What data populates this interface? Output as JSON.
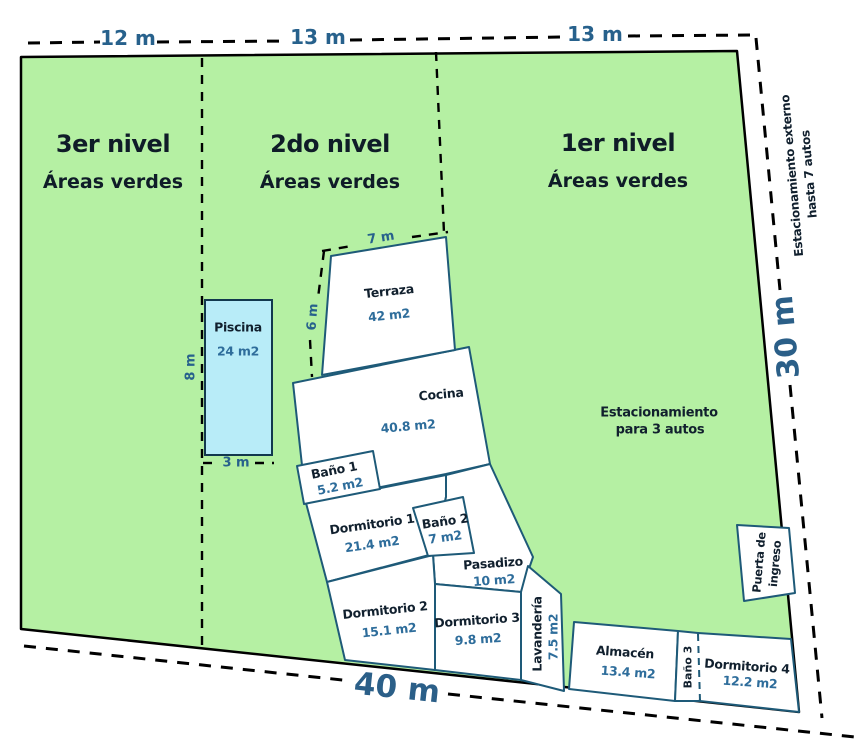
{
  "diagram": {
    "title_context": "terrain plan",
    "levels": [
      {
        "title": "3er nivel",
        "subtitle": "Áreas verdes"
      },
      {
        "title": "2do nivel",
        "subtitle": "Áreas verdes"
      },
      {
        "title": "1er nivel",
        "subtitle": "Áreas verdes"
      }
    ],
    "top_dims": [
      "12 m",
      "13 m",
      "13 m"
    ],
    "side_dims": {
      "right": "30 m",
      "bottom": "40 m"
    },
    "pool": {
      "name": "Piscina",
      "area": "24 m2",
      "width": "3 m",
      "height": "8 m"
    },
    "terrace_dims": {
      "top": "7 m",
      "left": "6 m"
    },
    "rooms": [
      {
        "name": "Terraza",
        "area": "42 m2"
      },
      {
        "name": "Cocina",
        "area": "40.8 m2"
      },
      {
        "name": "Baño 1",
        "area": "5.2 m2"
      },
      {
        "name": "Dormitorio 1",
        "area": "21.4 m2"
      },
      {
        "name": "Baño 2",
        "area": "7 m2"
      },
      {
        "name": "Pasadizo",
        "area": "10 m2"
      },
      {
        "name": "Dormitorio 2",
        "area": "15.1 m2"
      },
      {
        "name": "Dormitorio 3",
        "area": "9.8 m2"
      },
      {
        "name": "Lavandería",
        "area": "7.5 m2"
      },
      {
        "name": "Almacén",
        "area": "13.4 m2"
      },
      {
        "name": "Baño 3",
        "area": ""
      },
      {
        "name": "Dormitorio 4",
        "area": "12.2 m2"
      }
    ],
    "notes": {
      "external_parking": [
        "Estacionamiento externo",
        "hasta 7 autos"
      ],
      "internal_parking": [
        "Estacionamiento",
        "para 3 autos"
      ],
      "entrance": [
        "Puerta de",
        "ingreso"
      ]
    }
  },
  "colors": {
    "terrain_green": "#b5f0a3",
    "room_fill": "#ffffff",
    "room_stroke": "#1e5a78",
    "pool_fill": "#b8ecf8",
    "dim_blue": "#27618c",
    "area_blue": "#2e6d9b",
    "text_dark": "#11202e",
    "line_black": "#000000"
  }
}
